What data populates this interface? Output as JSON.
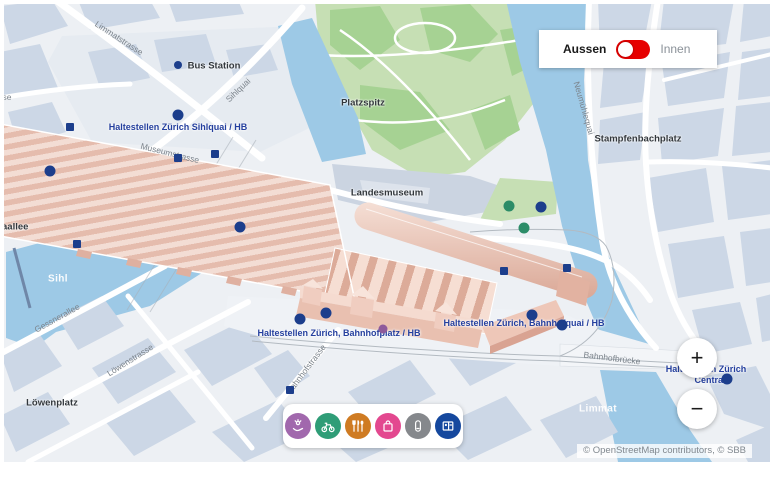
{
  "header": {
    "toggle": {
      "left_label": "Aussen",
      "right_label": "Innen",
      "state": "Aussen",
      "accent_color": "#e60000"
    }
  },
  "controls": {
    "zoom_in": "+",
    "zoom_out": "−"
  },
  "attribution": "© OpenStreetMap contributors, © SBB",
  "icon_bar": {
    "items": [
      {
        "name": "services",
        "color": "#a168ad"
      },
      {
        "name": "bike",
        "color": "#2f9d77"
      },
      {
        "name": "gastronomy",
        "color": "#cf7b22"
      },
      {
        "name": "shopping",
        "color": "#e3488f"
      },
      {
        "name": "lockers",
        "color": "#85888c"
      },
      {
        "name": "ticket-counter",
        "color": "#15489e"
      }
    ]
  },
  "map": {
    "street_labels": [
      {
        "text": "Limmatstrasse",
        "x": 119,
        "y": 38,
        "rot": 33
      },
      {
        "text": "Sihlquai",
        "x": 238,
        "y": 90,
        "rot": -44
      },
      {
        "text": "Museumstrasse",
        "x": 170,
        "y": 153,
        "rot": 14
      },
      {
        "text": "Neumühlequai",
        "x": 584,
        "y": 108,
        "rot": 74
      },
      {
        "text": "Gessnerallee",
        "x": 57,
        "y": 318,
        "rot": -29
      },
      {
        "text": "Löwenstrasse",
        "x": 130,
        "y": 360,
        "rot": -32
      },
      {
        "text": "Bahnhofstrasse",
        "x": 306,
        "y": 369,
        "rot": -53
      },
      {
        "text": "Bahnhofbrücke",
        "x": 612,
        "y": 358,
        "rot": 7
      },
      {
        "text": "se",
        "x": 7,
        "y": 97,
        "rot": 0
      }
    ],
    "place_labels": [
      {
        "text": "Bus Station",
        "x": 214,
        "y": 66
      },
      {
        "text": "Platzspitz",
        "x": 363,
        "y": 103
      },
      {
        "text": "Landesmuseum",
        "x": 387,
        "y": 193
      },
      {
        "text": "Stampfenbachplatz",
        "x": 638,
        "y": 139
      },
      {
        "text": "Löwenplatz",
        "x": 52,
        "y": 403
      },
      {
        "text": "aallee",
        "x": 2,
        "y": 227,
        "align": "left"
      }
    ],
    "transit_labels": [
      {
        "text": "Haltestellen Zürich Sihlquai / HB",
        "x": 178,
        "y": 127
      },
      {
        "text": "Haltestellen Zürich, Bahnhofplatz / HB",
        "x": 339,
        "y": 333
      },
      {
        "text": "Haltestellen Zürich, Bahnhofquai / HB",
        "x": 524,
        "y": 323
      },
      {
        "text": "Haltestellen Zürich",
        "x": 706,
        "y": 369
      },
      {
        "text": "Central",
        "x": 710,
        "y": 380
      }
    ],
    "water_labels": [
      {
        "text": "Sihl",
        "x": 58,
        "y": 279
      },
      {
        "text": "Limmat",
        "x": 598,
        "y": 409
      }
    ],
    "markers": [
      {
        "type": "stop-circle",
        "shape": "circle",
        "color": "#1c3e8c",
        "size": 11,
        "points": [
          [
            178,
            115
          ],
          [
            50,
            171
          ],
          [
            240,
            227
          ],
          [
            300,
            319
          ],
          [
            326,
            313
          ],
          [
            532,
            315
          ],
          [
            562,
            325
          ],
          [
            541,
            207
          ],
          [
            727,
            379
          ]
        ]
      },
      {
        "type": "stop-circle-small",
        "shape": "circle",
        "color": "#1c3e8c",
        "size": 8,
        "points": [
          [
            178,
            65
          ]
        ]
      },
      {
        "type": "poi-green",
        "shape": "circle",
        "color": "#2c8c68",
        "size": 11,
        "points": [
          [
            509,
            206
          ],
          [
            524,
            228
          ]
        ]
      },
      {
        "type": "poi-purple",
        "shape": "circle",
        "color": "#8e5a9b",
        "size": 9,
        "points": [
          [
            383,
            329
          ]
        ]
      },
      {
        "type": "stop-square",
        "shape": "square",
        "color": "#1c3e8c",
        "size": 8,
        "points": [
          [
            70,
            127
          ],
          [
            178,
            158
          ],
          [
            215,
            154
          ],
          [
            77,
            244
          ],
          [
            290,
            390
          ],
          [
            504,
            271
          ],
          [
            567,
            268
          ]
        ]
      }
    ],
    "colors": {
      "water": "#9dc9e6",
      "park": "#c6dfb4",
      "park_dark": "#a6d293",
      "block": "#ccd7e6",
      "station_roof": "#f3ddd4",
      "station_shadow": "#dcab99",
      "transit_blue": "#243f9e",
      "marker_navy": "#1c3e8c"
    }
  }
}
